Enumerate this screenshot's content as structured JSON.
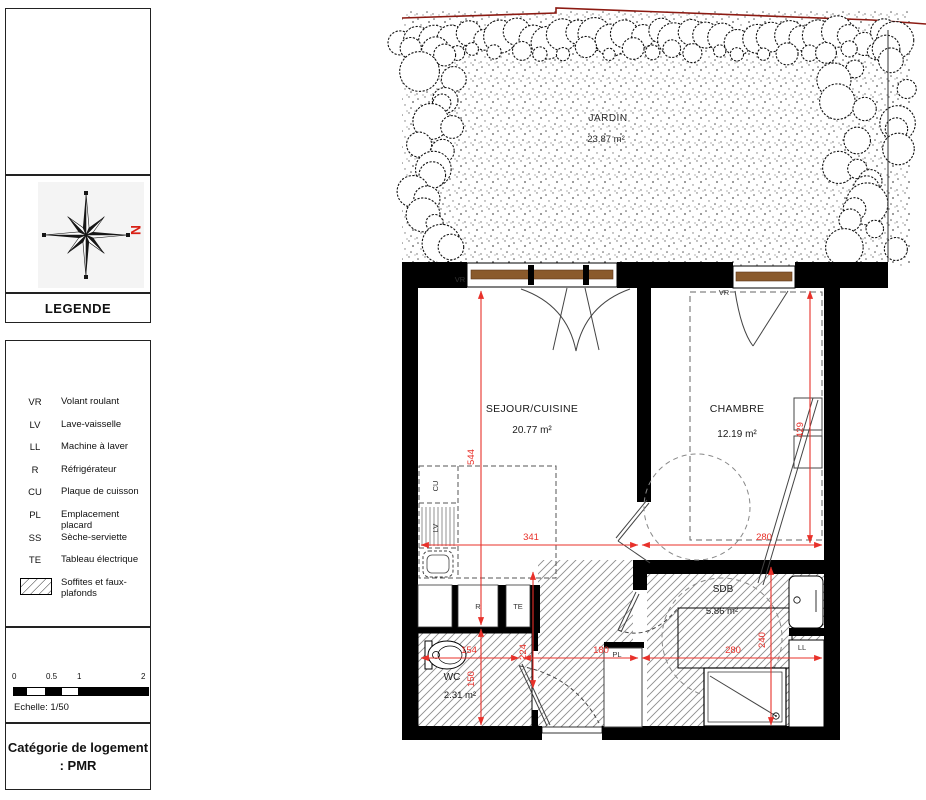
{
  "sidebar": {
    "legend_title": "LEGENDE",
    "legend_items": [
      {
        "abbr": "VR",
        "label": "Volant roulant"
      },
      {
        "abbr": "LV",
        "label": "Lave-vaisselle"
      },
      {
        "abbr": "LL",
        "label": "Machine à laver"
      },
      {
        "abbr": "R",
        "label": "Réfrigérateur"
      },
      {
        "abbr": "CU",
        "label": "Plaque de cuisson"
      },
      {
        "abbr": "PL",
        "label": "Emplacement placard"
      },
      {
        "abbr": "SS",
        "label": "Sèche-serviette"
      },
      {
        "abbr": "TE",
        "label": "Tableau électrique"
      },
      {
        "abbr": "",
        "label": "Soffites et faux-plafonds",
        "symbol": "hatch"
      }
    ],
    "compass_north": "N",
    "scale_ticks": [
      "0",
      "0.5",
      "1",
      "2"
    ],
    "scale_caption": "Echelle: 1/50",
    "category_line1": "Catégorie de logement",
    "category_line2": ": PMR"
  },
  "plan": {
    "garden": {
      "name": "JARDIN",
      "area": "23.87 m²"
    },
    "sejour": {
      "name": "SEJOUR/CUISINE",
      "area": "20.77 m²"
    },
    "chambre": {
      "name": "CHAMBRE",
      "area": "12.19 m²"
    },
    "sdb": {
      "name": "SDB",
      "area": "5.86 m²"
    },
    "wc": {
      "name": "WC",
      "area": "2.31 m²"
    },
    "tags": {
      "vr_left": "VR",
      "vr_right": "VR",
      "cu": "CU",
      "lv": "LV",
      "r": "R",
      "te": "TE",
      "pl": "PL",
      "ll": "LL"
    },
    "dims": {
      "sejour_height": "544",
      "wc_height": "150",
      "chambre_height": "429",
      "hall_height": "224",
      "sdb_height": "240",
      "sejour_width": "341",
      "chambre_width": "280",
      "wc_width": "154",
      "hall_width": "180",
      "sdb_width": "280"
    },
    "colors": {
      "dimension_red": "#e8312a",
      "boundary_red": "#8c1a12",
      "window_brown": "#8a5a2c",
      "wall_black": "#000000"
    }
  }
}
